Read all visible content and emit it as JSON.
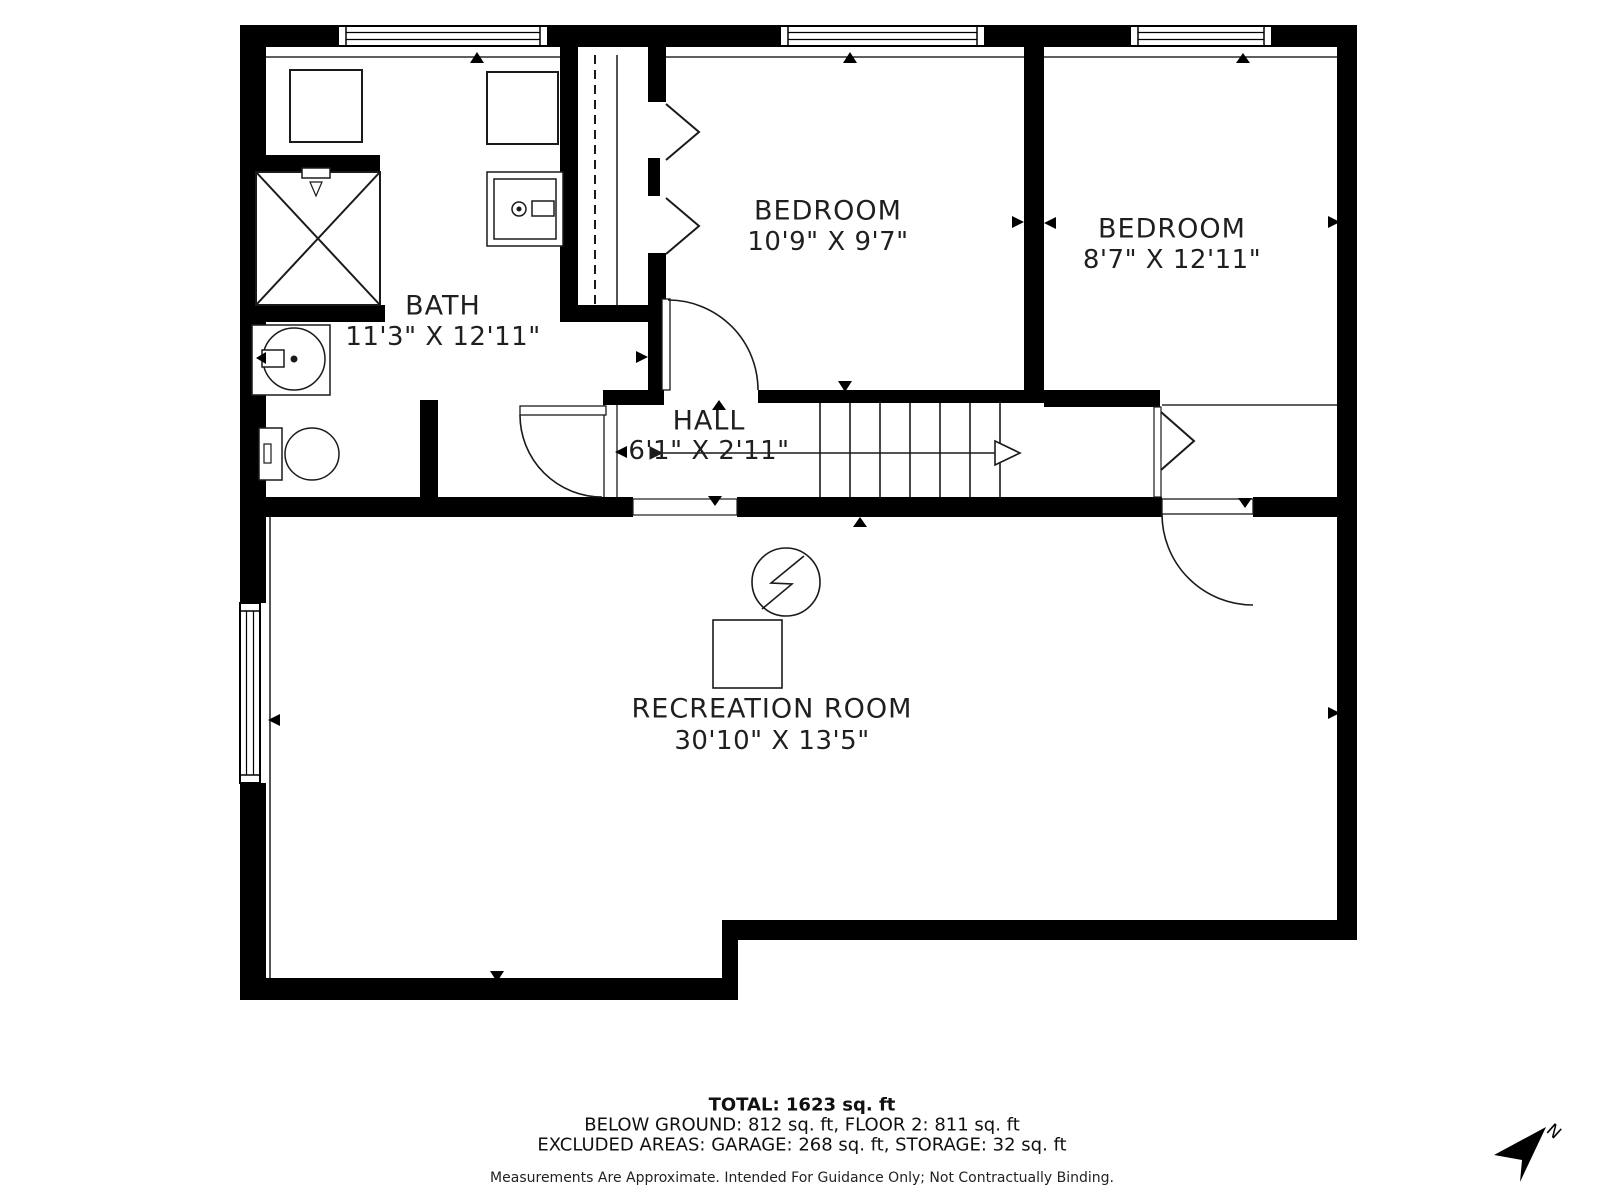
{
  "meta": {
    "type": "floor-plan-below-ground-level",
    "colors": {
      "background": "#ffffff",
      "walls": "#000000",
      "thin_lines": "#2a2a2a",
      "text": "#1f1f1f"
    }
  },
  "rooms": [
    {
      "id": "bath",
      "name": "BATH",
      "dims": "11'3\" X 12'11\""
    },
    {
      "id": "bedroom1",
      "name": "BEDROOM",
      "dims": "10'9\" X 9'7\""
    },
    {
      "id": "bedroom2",
      "name": "BEDROOM",
      "dims": "8'7\" X 12'11\""
    },
    {
      "id": "hall",
      "name": "HALL",
      "dims": "6'1\" X 2'11\""
    },
    {
      "id": "recreation",
      "name": "RECREATION ROOM",
      "dims": "30'10\" X 13'5\""
    }
  ],
  "summary": {
    "total": "TOTAL: 1623 sq. ft",
    "floors": "BELOW GROUND: 812 sq. ft, FLOOR 2: 811 sq. ft",
    "excluded": "EXCLUDED AREAS: GARAGE: 268 sq. ft, STORAGE: 32 sq. ft"
  },
  "disclaimer": "Measurements Are Approximate. Intended For Guidance Only; Not Contractually Binding.",
  "compass": {
    "label": "N"
  },
  "icons": {
    "north-arrow": "dart pointing up-right",
    "stair-direction-arrow": "line with open arrowhead",
    "electrical-panel-icon": "circle with lightning bolt",
    "shower-icon": "square with X",
    "toilet-icon": "tank and bowl",
    "sink-icon": "square with faucet circle",
    "vanity-sink-icon": "circle basin in square",
    "washer-icon": "square",
    "dryer-icon": "square",
    "furnace-icon": "square",
    "bifold-door-icon": "chevron",
    "swing-door-icon": "quarter arc"
  }
}
